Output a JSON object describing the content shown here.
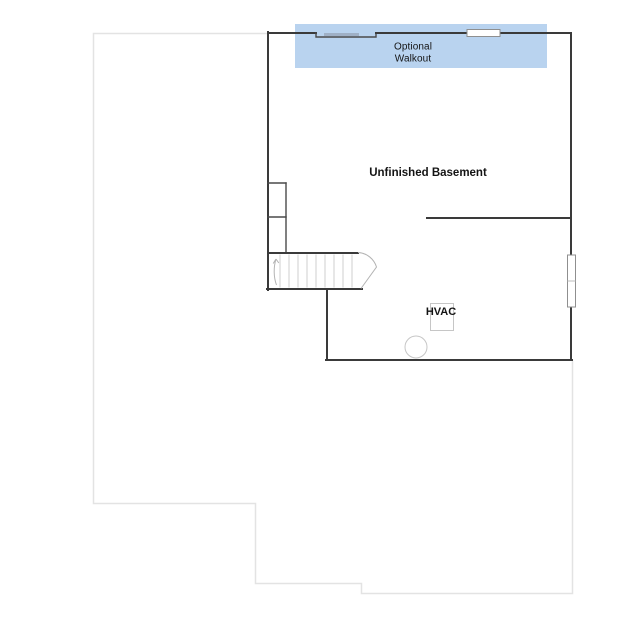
{
  "labels": {
    "optional_walkout": "Optional\nWalkout",
    "unfinished_basement": "Unfinished Basement",
    "hvac": "HVAC"
  },
  "colors": {
    "background": "#ffffff",
    "walkout_highlight": "#b9d3ef",
    "wall_line": "#3a3a3a",
    "footprint_line": "#e3e3e3",
    "stair_step_line": "#cfcfcf",
    "fixture_line": "#c6c6c6",
    "window_glazing": "#9fb0c6",
    "label_text": "#141414"
  },
  "icons": {
    "stair_direction_arrow": "curved-up-arrow",
    "stair_run_pointer": "angled-pointer",
    "window_symbol": "white-inset-rectangle",
    "water_heater_symbol": "circle-outline",
    "hvac_unit_symbol": "square-outline"
  }
}
